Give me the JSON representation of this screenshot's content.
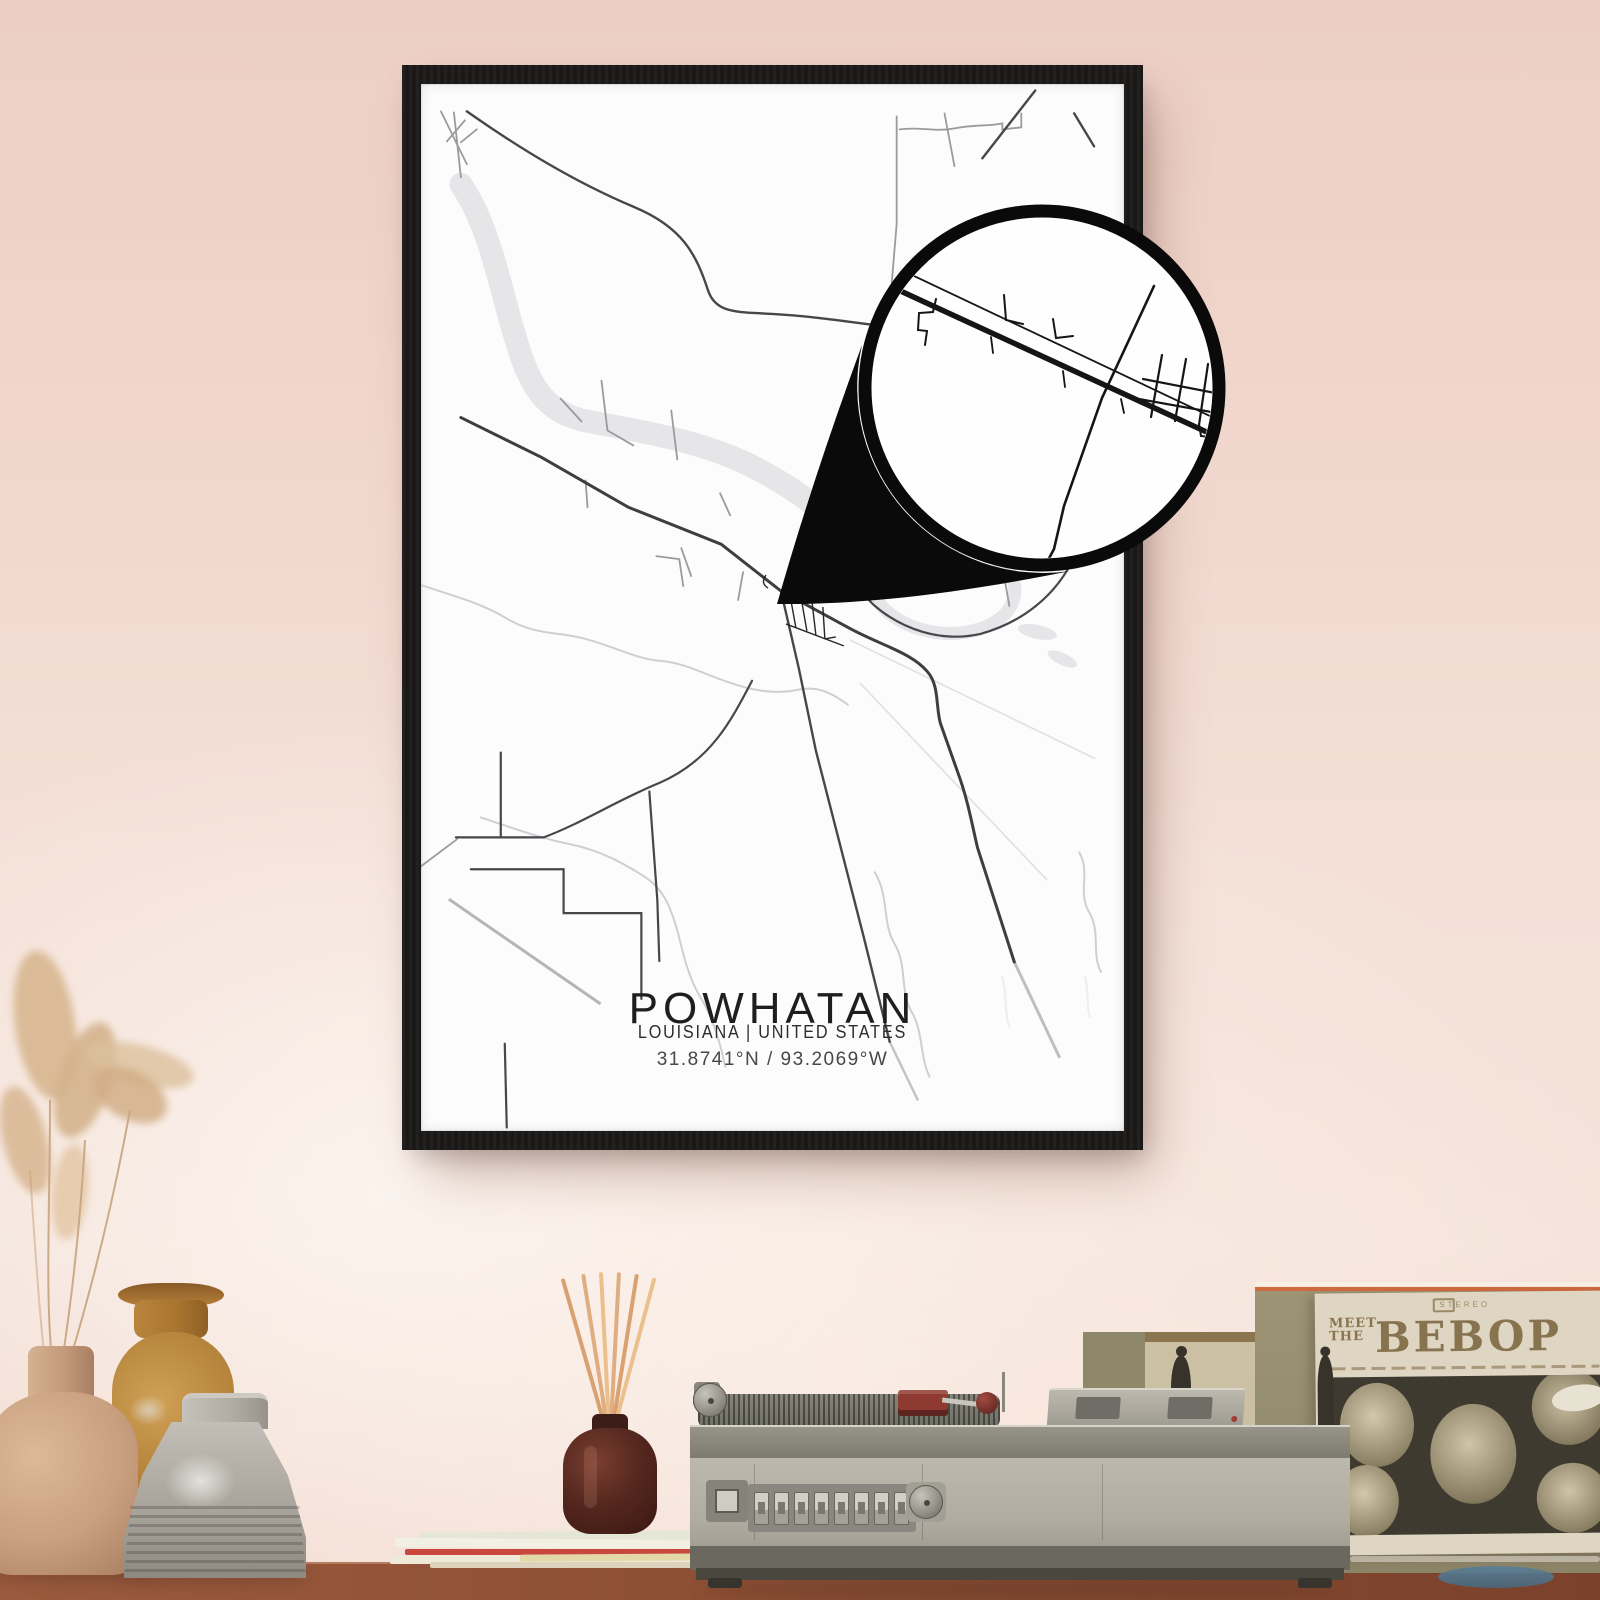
{
  "poster": {
    "title": "POWHATAN",
    "subtitle": "LOUISIANA | UNITED STATES",
    "coordinates": "31.8741°N / 93.2069°W"
  },
  "album": {
    "line1": "MEET",
    "line2": "THE",
    "title": "BEBOP",
    "header": "STEREO"
  },
  "colors": {
    "wall_pink": "#f0d6cc",
    "wall_highlight": "#f8ece5",
    "frame_black": "#1b1917",
    "map_paper": "#fcfcfd",
    "map_water": "#e6e6e9",
    "map_road_dark": "#3e3e42",
    "magnifier_black": "#0a0a0a",
    "table_wood": "#8a4a33",
    "album_cream": "#ded6c2",
    "album_brown": "#87734e",
    "crate_olive": "#978f6e",
    "crate_edge_orange": "#cf6b3e",
    "diffuser_brown": "#4e2820",
    "reed_tan": "#e0ad80",
    "player_gray": "#b3afa5",
    "headshell_red": "#8f3a30",
    "vase_tan": "#c9a080",
    "vase_amber": "#b17f37",
    "vase_gray": "#a7a39b",
    "grass_beige": "#d9b893",
    "coaster_blue": "#5b7f96"
  }
}
